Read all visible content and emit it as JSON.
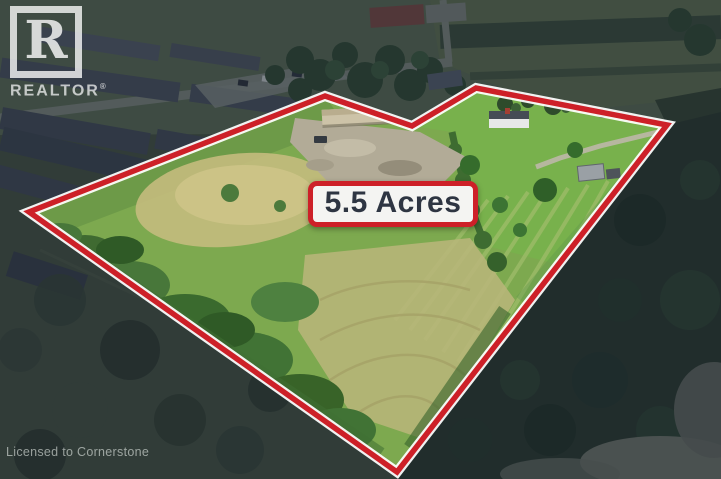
{
  "logo": {
    "letter": "R",
    "name": "REALTOR",
    "registered": "®"
  },
  "badge": {
    "text": "5.5 Acres"
  },
  "watermark": {
    "text": "Licensed to Cornerstone"
  },
  "colors": {
    "boundary_red": "#cd2028",
    "boundary_casing_white": "#ffffff",
    "badge_background": "#f4f4f2",
    "badge_border": "#cd2028",
    "badge_text": "#2e3542",
    "logo_white": "#ffffff",
    "watermark_gray": "#dee5e0",
    "field_green": "#7da94f",
    "outside_dim_overlay": "rgba(18,28,48,0.40)"
  }
}
